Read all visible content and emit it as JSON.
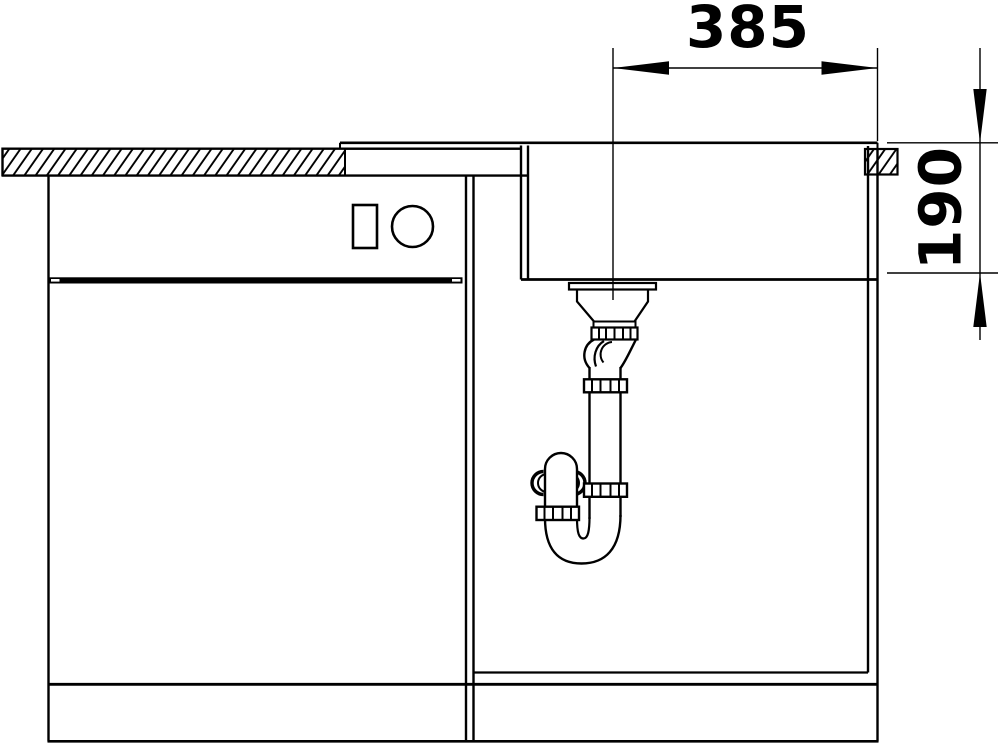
{
  "colors": {
    "background": "#ffffff",
    "line": "#000000"
  },
  "dimensions": {
    "drain_offset": {
      "label": "385"
    },
    "bowl_depth": {
      "label": "190"
    }
  }
}
